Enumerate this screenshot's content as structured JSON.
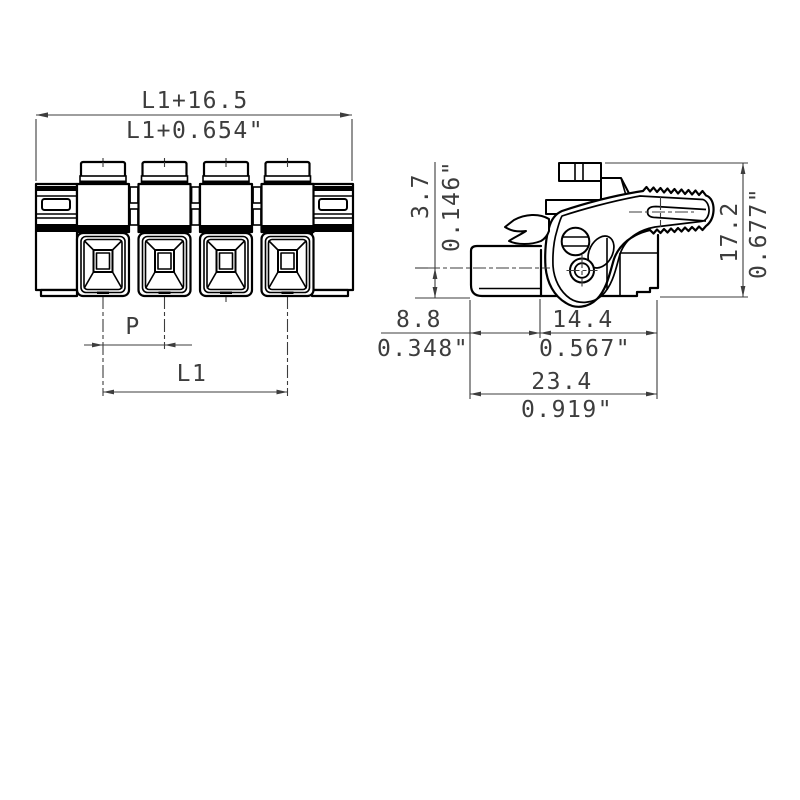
{
  "drawing": {
    "front_view": {
      "total_width_mm": "L1+16.5",
      "total_width_inch": "L1+0.654\"",
      "pitch_label": "P",
      "length_label": "L1"
    },
    "side_view": {
      "axis_height_mm": "3.7",
      "axis_height_inch": "0.146\"",
      "overall_height_mm": "17.2",
      "overall_height_inch": "0.677\"",
      "front_depth_mm": "8.8",
      "front_depth_inch": "0.348\"",
      "rear_depth_mm": "14.4",
      "rear_depth_inch": "0.567\"",
      "total_depth_mm": "23.4",
      "total_depth_inch": "0.919\""
    },
    "colors": {
      "line": "#000000",
      "thin_line": "#3d3d3d",
      "background": "#ffffff"
    }
  }
}
